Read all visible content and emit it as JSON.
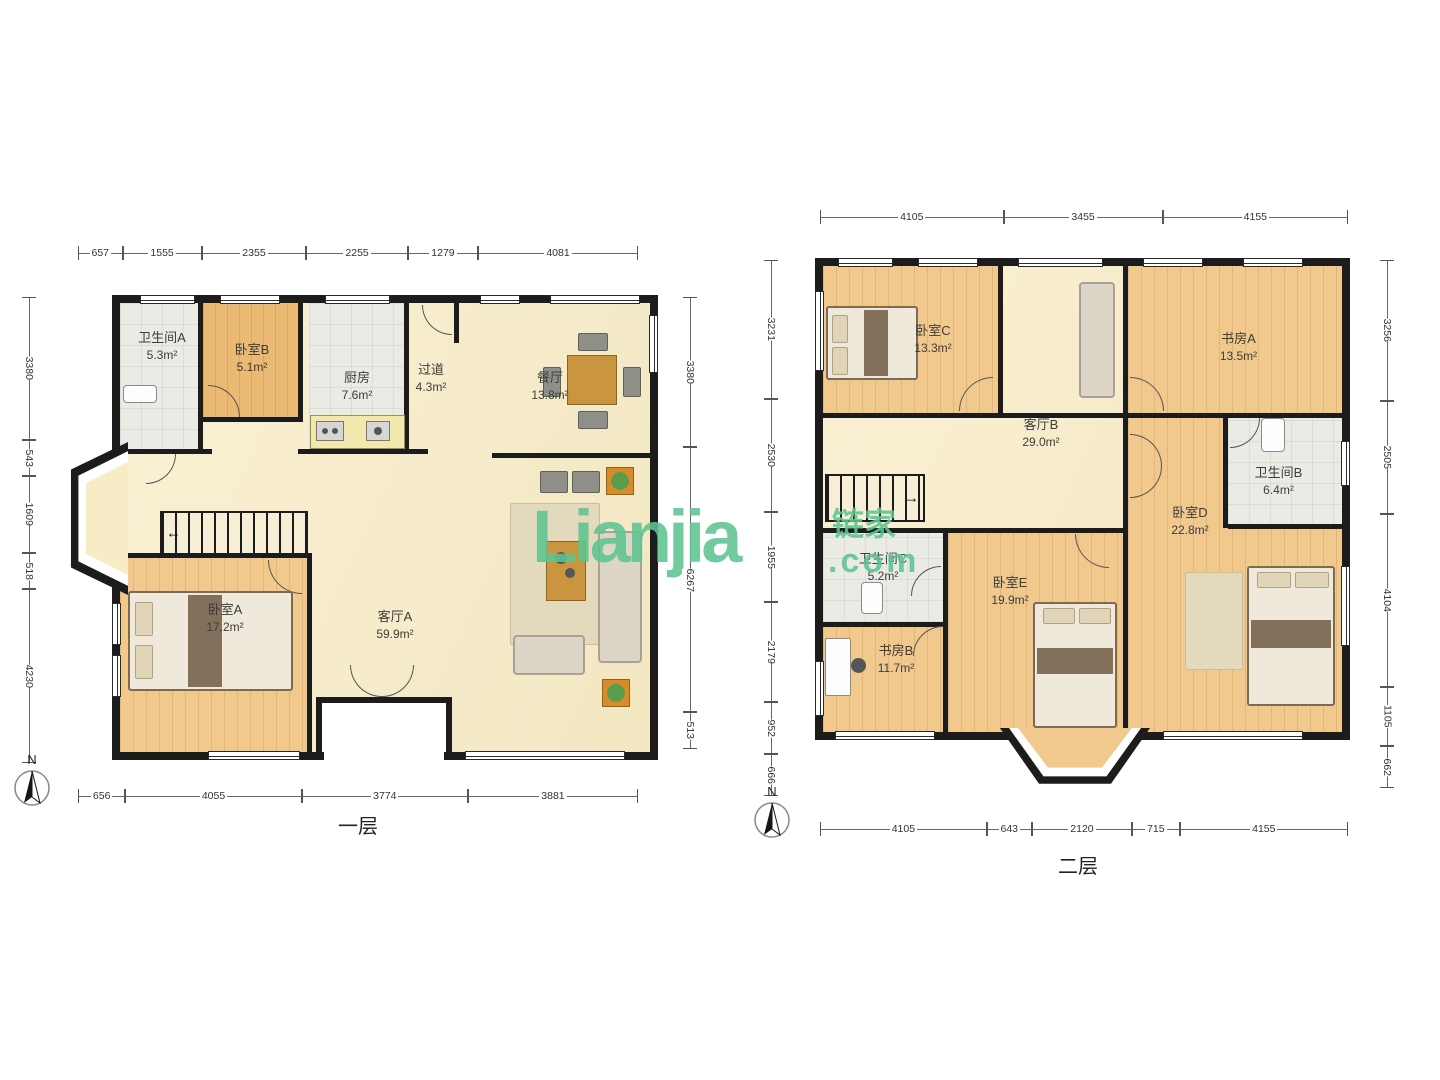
{
  "watermark": {
    "brand": "Lianjia",
    "cn": "链家",
    "suffix": ".com",
    "color": "#5ec492"
  },
  "floor1": {
    "label": "一层",
    "compass": "N",
    "stairs_arrow": "←",
    "rooms": {
      "bath_a": {
        "name": "卫生间A",
        "area": "5.3m²"
      },
      "bed_b": {
        "name": "卧室B",
        "area": "5.1m²"
      },
      "kitchen": {
        "name": "厨房",
        "area": "7.6m²"
      },
      "hallway": {
        "name": "过道",
        "area": "4.3m²"
      },
      "dining": {
        "name": "餐厅",
        "area": "13.8m²"
      },
      "bed_a": {
        "name": "卧室A",
        "area": "17.2m²"
      },
      "living_a": {
        "name": "客厅A",
        "area": "59.9m²"
      }
    },
    "dims": {
      "top": [
        "657",
        "1555",
        "2355",
        "2255",
        "1279",
        "4081"
      ],
      "bottom": [
        "656",
        "4055",
        "3774",
        "3881"
      ],
      "left": [
        "3380",
        "543",
        "1609",
        "518",
        "4230"
      ],
      "right": [
        "3380",
        "6267",
        "513"
      ]
    }
  },
  "floor2": {
    "label": "二层",
    "compass": "N",
    "stairs_arrow": "→",
    "rooms": {
      "bed_c": {
        "name": "卧室C",
        "area": "13.3m²"
      },
      "living_b": {
        "name": "客厅B",
        "area": "29.0m²"
      },
      "study_a": {
        "name": "书房A",
        "area": "13.5m²"
      },
      "bath_b": {
        "name": "卫生间B",
        "area": "6.4m²"
      },
      "bed_d": {
        "name": "卧室D",
        "area": "22.8m²"
      },
      "bath_c": {
        "name": "卫生间C",
        "area": "5.2m²"
      },
      "bed_e": {
        "name": "卧室E",
        "area": "19.9m²"
      },
      "study_b": {
        "name": "书房B",
        "area": "11.7m²"
      }
    },
    "dims": {
      "top": [
        "4105",
        "3455",
        "4155"
      ],
      "bottom": [
        "4105",
        "643",
        "2120",
        "715",
        "4155"
      ],
      "left": [
        "3231",
        "2530",
        "1955",
        "2179",
        "952",
        "666"
      ],
      "right": [
        "3256",
        "2505",
        "4104",
        "1105",
        "662"
      ]
    }
  }
}
